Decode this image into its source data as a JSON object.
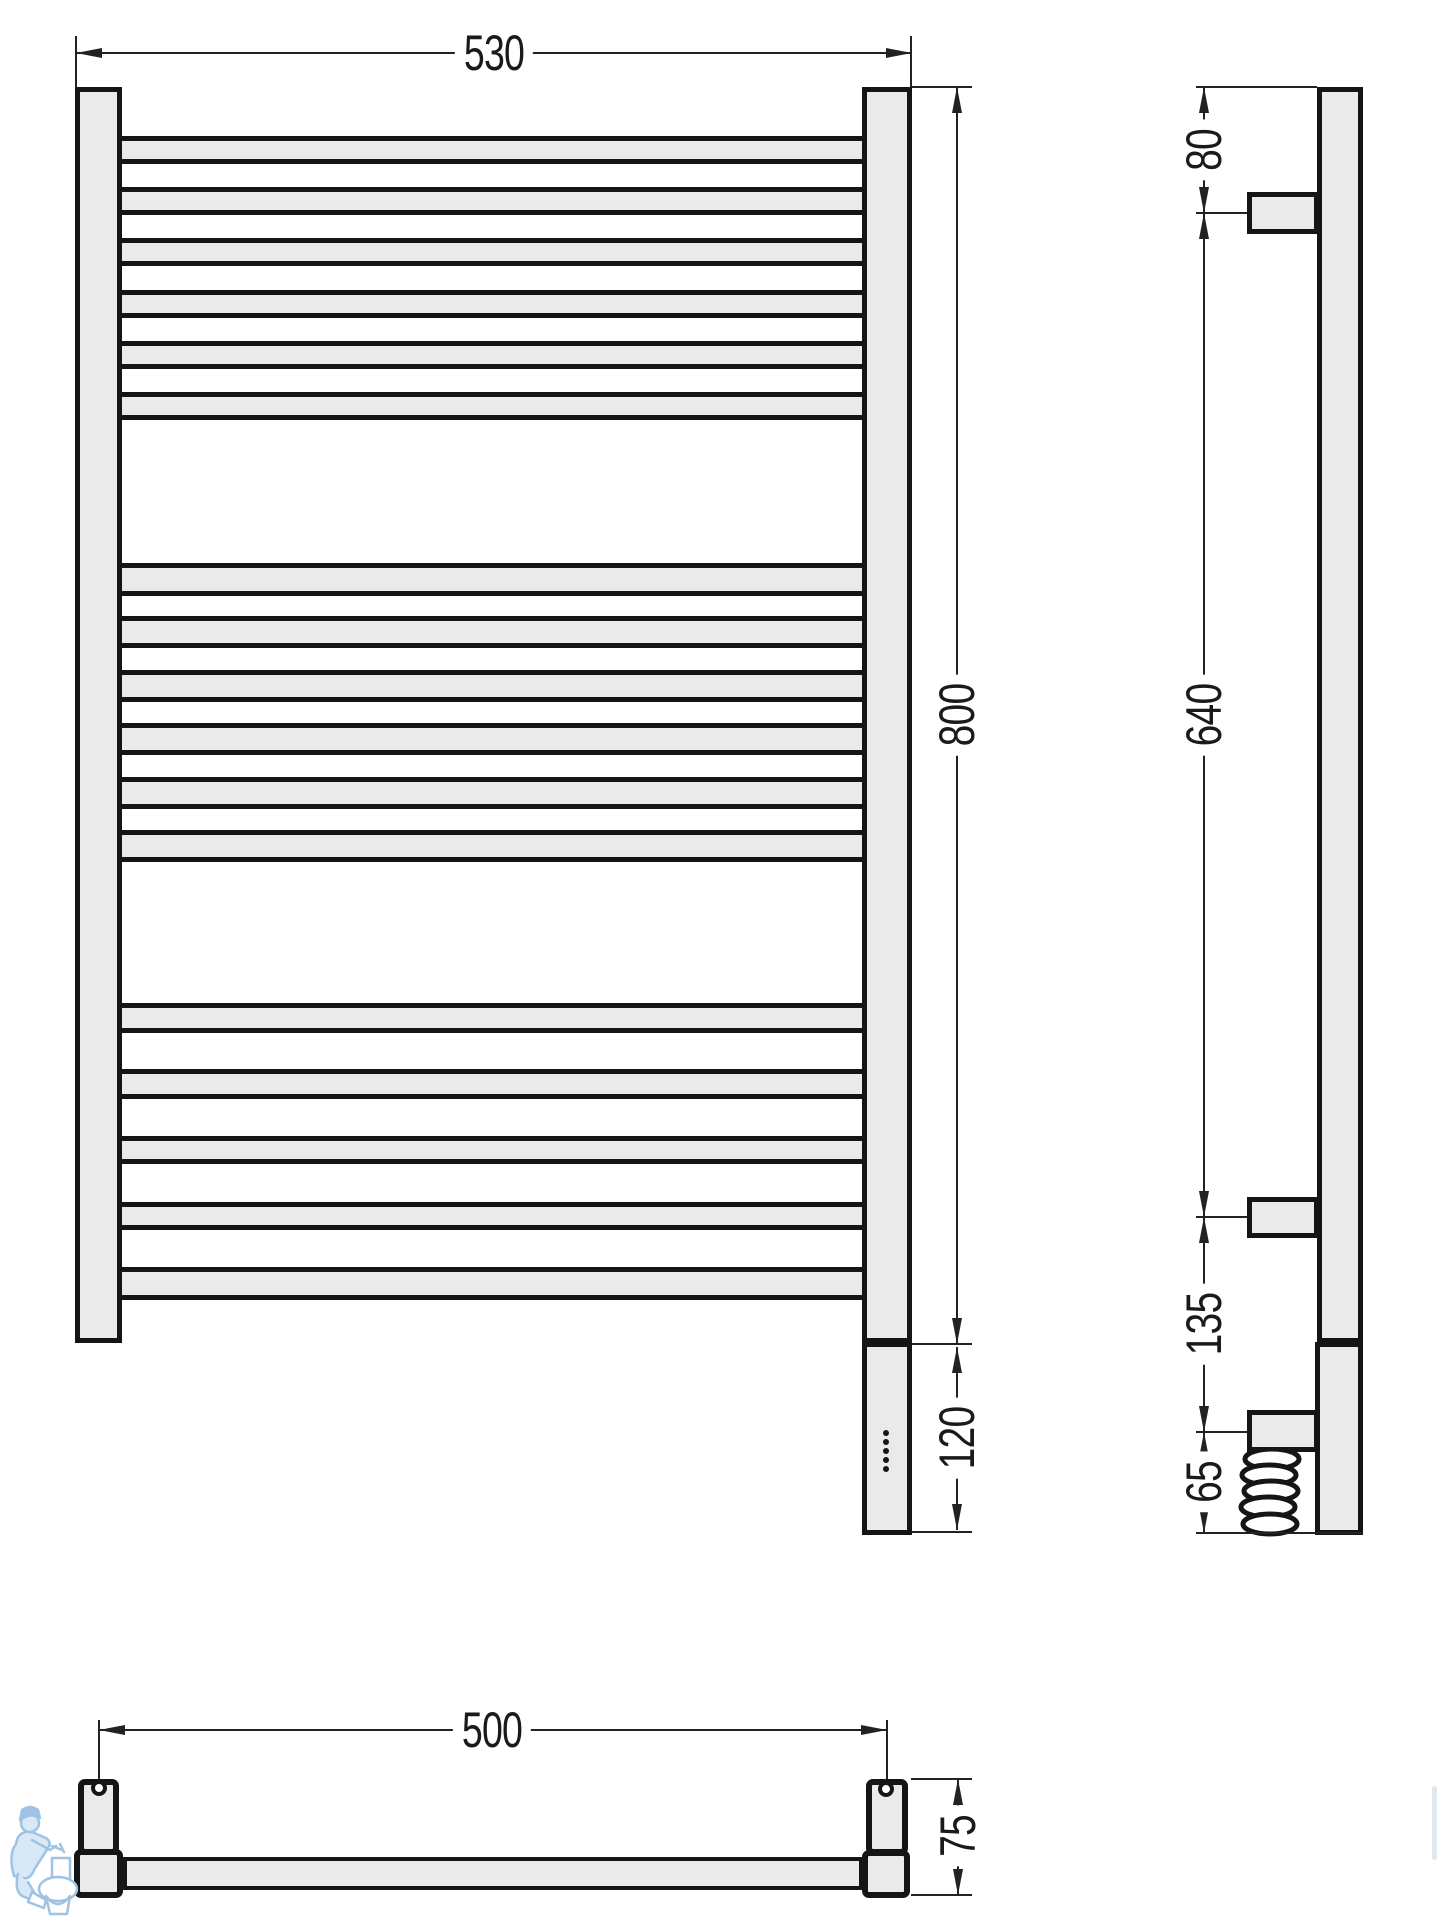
{
  "document": {
    "type": "technical dimensional drawing",
    "subject": "ladder heated towel rail with electric heating module, front / side / bottom views"
  },
  "dimensions": {
    "front_width": "530",
    "front_height": "800",
    "heater_height": "120",
    "side_top_to_bracket": "80",
    "side_bracket_span": "640",
    "side_bracket_to_cable": "135",
    "side_cable_to_bottom": "65",
    "mount_span": "500",
    "mount_depth": "75"
  },
  "front_view": {
    "indicator_dot_count": 5,
    "rungs": [
      {
        "top": 136,
        "h": 28
      },
      {
        "top": 187,
        "h": 28
      },
      {
        "top": 238,
        "h": 28
      },
      {
        "top": 290,
        "h": 28
      },
      {
        "top": 341,
        "h": 28
      },
      {
        "top": 392,
        "h": 28
      },
      {
        "top": 563,
        "h": 33
      },
      {
        "top": 616,
        "h": 32
      },
      {
        "top": 670,
        "h": 32
      },
      {
        "top": 723,
        "h": 32
      },
      {
        "top": 777,
        "h": 32
      },
      {
        "top": 830,
        "h": 32
      },
      {
        "top": 1003,
        "h": 30
      },
      {
        "top": 1069,
        "h": 30
      },
      {
        "top": 1136,
        "h": 28
      },
      {
        "top": 1202,
        "h": 28
      },
      {
        "top": 1267,
        "h": 33
      }
    ]
  },
  "side_view": {
    "coil_loop_count": 5
  },
  "colors": {
    "outline": "#151515",
    "fill": "#eaeaea",
    "dim_line": "#222222",
    "watermark_stroke": "#9fc3e4",
    "watermark_fill": "#d8e8f6"
  }
}
